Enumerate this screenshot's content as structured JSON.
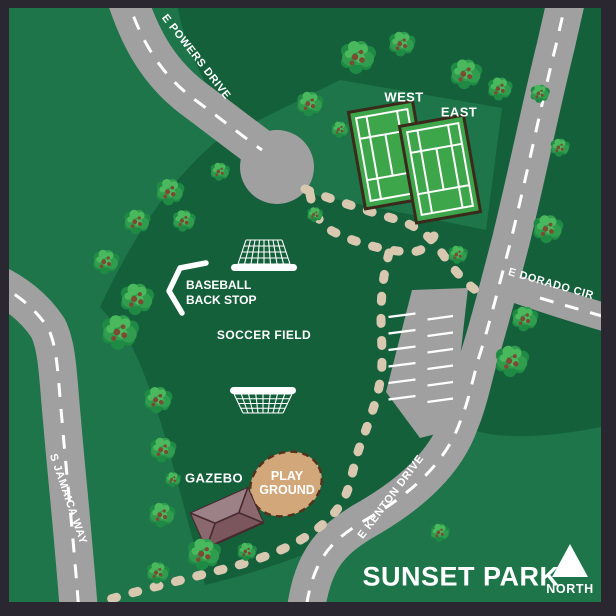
{
  "title": "SUNSET PARK",
  "compass": {
    "label": "NORTH"
  },
  "roads": {
    "powers": "E POWERS DRIVE",
    "dorado": "E DORADO CIR",
    "kenton": "E KENTON DRIVE",
    "jamaica": "S JAMAICA WAY"
  },
  "tennis": {
    "west": "WEST",
    "east": "EAST"
  },
  "facilities": {
    "baseball": {
      "line1": "BASEBALL",
      "line2": "BACK STOP"
    },
    "soccer": "SOCCER FIELD",
    "gazebo": "GAZEBO",
    "playground": {
      "line1": "PLAY",
      "line2": "GROUND"
    }
  },
  "colors": {
    "frame": "#2b2731",
    "green_light": "#1d7549",
    "green_dark": "#14603b",
    "road": "#a0a0a0",
    "road_line": "#ffffff",
    "path": "#d8c8b0",
    "court_fill": "#3da54a",
    "court_line": "#ffffff",
    "court_border": "#3a2a1c",
    "playground_fill": "#d2a87b",
    "playground_border": "#53331d",
    "gazebo_light": "#9c8287",
    "gazebo_mid": "#8a686e",
    "gazebo_dark": "#7b575d",
    "gazebo_outline": "#46292e",
    "tree_base": "#1f8a44",
    "tree_mid": "#2f9c4e",
    "tree_light": "#4ab95e",
    "tree_brown": "#7d4a32",
    "icon": "#ffffff",
    "text": "#ffffff"
  }
}
